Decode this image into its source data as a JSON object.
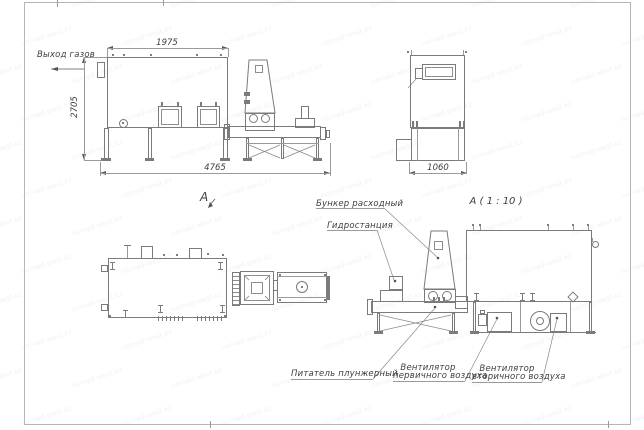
{
  "watermark": {
    "text": "nomad-west.kz"
  },
  "labels": {
    "gas_outlet": "Выход газов",
    "view_a": "А",
    "detail_title": "А ( 1 : 10 )"
  },
  "dimensions": {
    "side_top_width": "1975",
    "side_height": "2705",
    "side_total_width": "4765",
    "end_width": "1060"
  },
  "callouts": {
    "hopper": "Бункер расходный",
    "hydro_station": "Гидростанция",
    "feeder": "Питатель плунжерный",
    "fan_primary_l1": "Вентилятор",
    "fan_primary_l2": "первичного воздуха",
    "fan_secondary_l1": "Вентилятор",
    "fan_secondary_l2": "вторичного воздуха"
  }
}
